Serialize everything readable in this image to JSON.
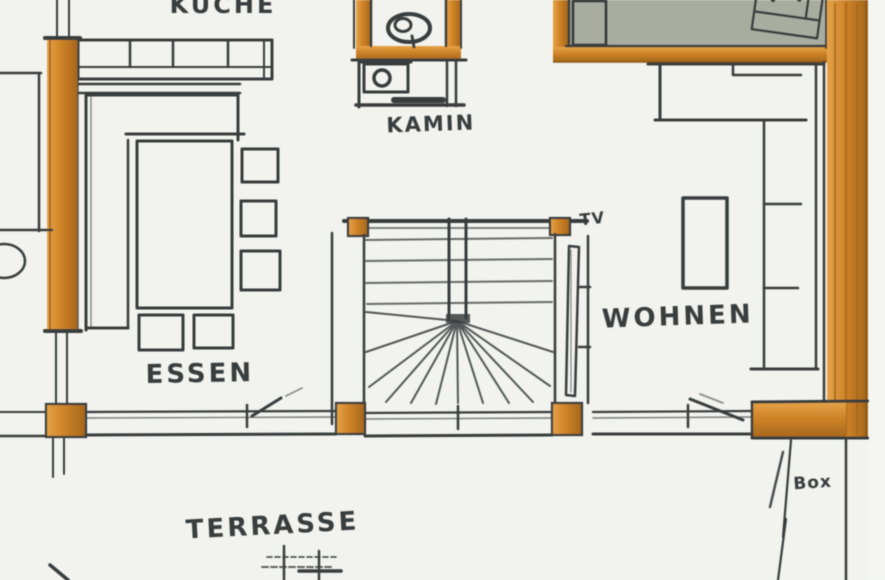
{
  "plan": {
    "kind": "hand-drawn floor plan sketch",
    "labels": {
      "kitchen": "KÜCHE",
      "fireplace": "KAMIN",
      "tv": "TV",
      "living": "WOHNEN",
      "dining": "ESSEN",
      "terrace": "TERRASSE",
      "box": "Box"
    },
    "colors": {
      "paper": "#f2f3ee",
      "ink": "#383c3e",
      "wood": "#cf8327",
      "wood_dark": "#a4671c",
      "wood_light": "#e6a349",
      "wood_edge": "#8a5a17",
      "terrace_gray": "#a9ada0"
    }
  }
}
